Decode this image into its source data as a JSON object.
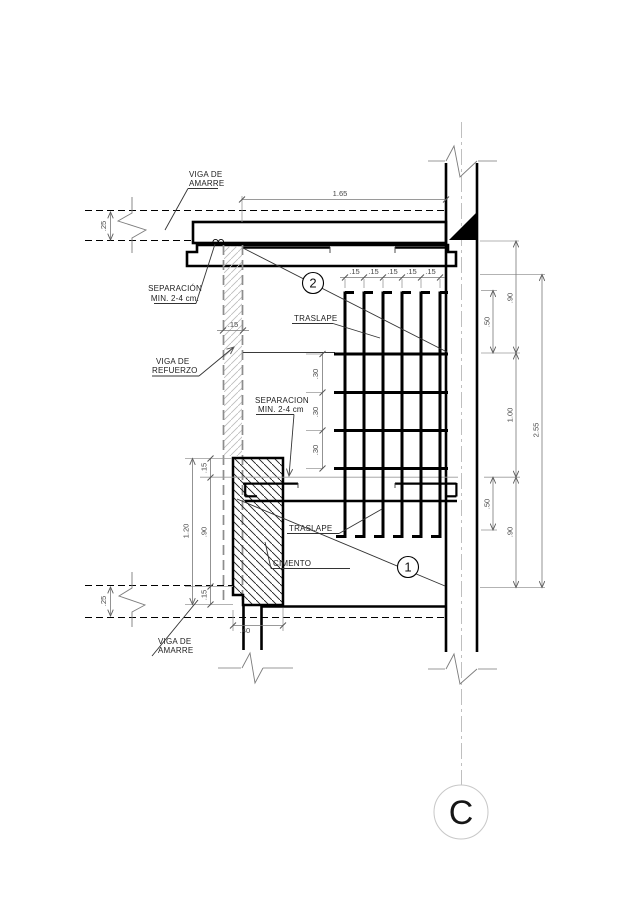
{
  "drawing": {
    "grid_bubble": "C",
    "callouts": {
      "upper": "2",
      "lower": "1"
    },
    "labels": {
      "viga_amarre_top_l1": "VIGA DE",
      "viga_amarre_top_l2": "AMARRE",
      "separacion_top_l1": "SEPARACIÓN",
      "separacion_top_l2": "MIN. 2-4 cm.",
      "viga_refuerzo_l1": "VIGA DE",
      "viga_refuerzo_l2": "REFUERZO",
      "separacion_mid_l1": "SEPARACION",
      "separacion_mid_l2": "MIN. 2-4 cm",
      "traslape_upper": "TRASLAPE",
      "traslape_lower": "TRASLAPE",
      "cimento": "CIMENTO",
      "viga_amarre_bottom_l1": "VIGA DE",
      "viga_amarre_bottom_l2": "AMARRE"
    },
    "dims": {
      "top_span": "1.65",
      "beam_depth_top": ".25",
      "beam_depth_bottom": ".25",
      "strip_width": ".15",
      "stirrup_top": [
        ".15",
        ".15",
        ".15",
        ".15",
        ".15"
      ],
      "stirrup_mid": [
        ".30",
        ".30",
        ".30"
      ],
      "right_90_top": ".90",
      "right_50_top": ".50",
      "right_100": "1.00",
      "right_50_bot": ".50",
      "right_90_bot": ".90",
      "right_total": "2.55",
      "left_total": "1.20",
      "left_15_top": ".15",
      "left_90": ".90",
      "left_15_bot": ".15",
      "footing_width": ".40"
    }
  }
}
